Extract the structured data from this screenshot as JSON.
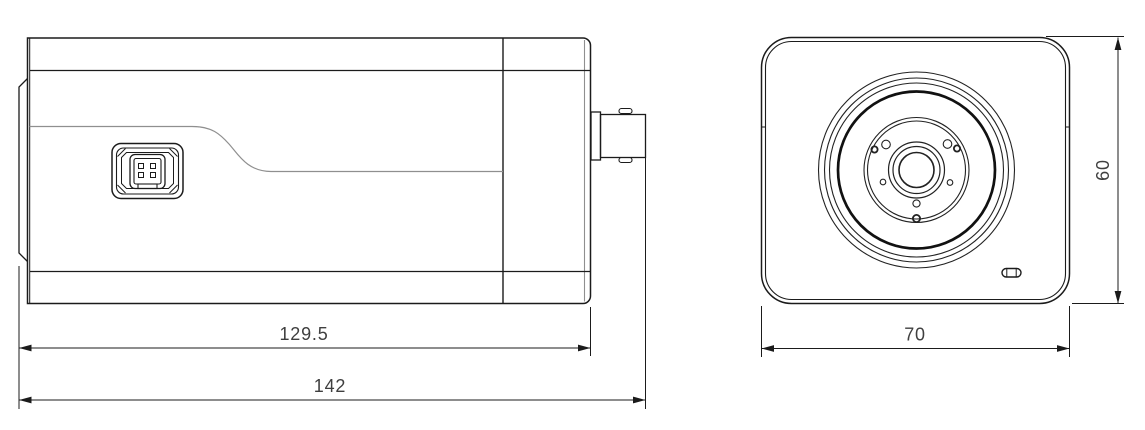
{
  "drawing": {
    "type": "two-view dimensional technical drawing of a box camera",
    "background_color": "#ffffff",
    "line_color": "#1b1b1b",
    "thin_line_color": "#8f8f8f",
    "dimension_text_color": "#3f3f3f",
    "dimensions": {
      "side_body_length": "129.5",
      "side_total_length": "142",
      "front_width": "70",
      "front_height": "60"
    }
  }
}
